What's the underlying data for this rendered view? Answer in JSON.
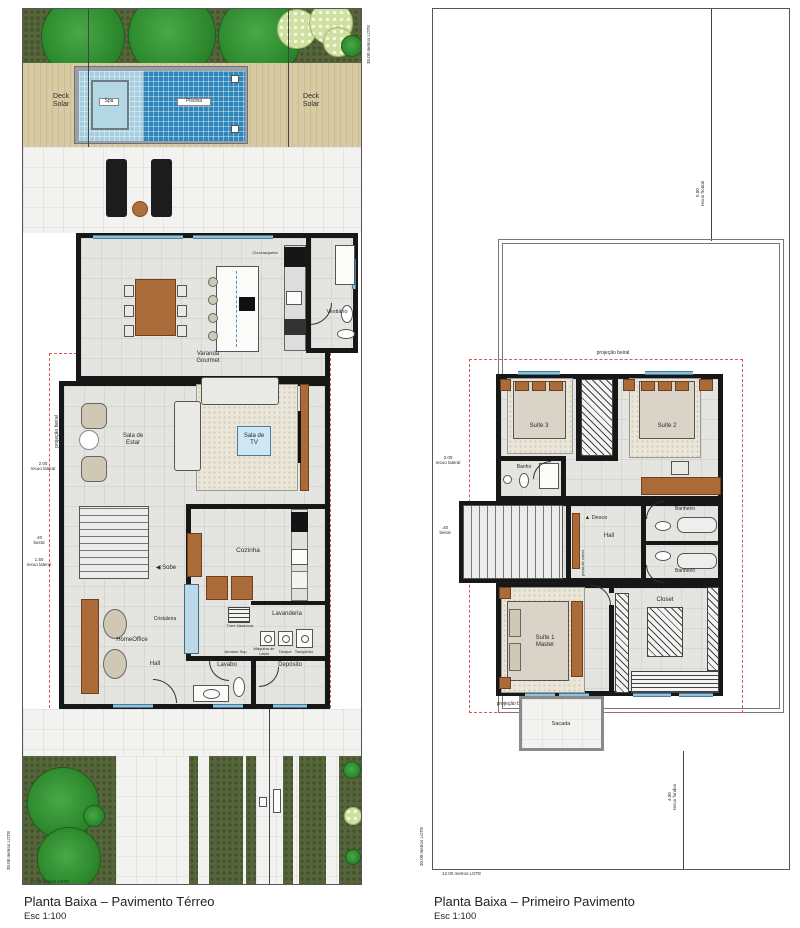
{
  "colors": {
    "wall": "#171717",
    "red_dash": "#dd5555",
    "pool_blue": "#2f86bd",
    "spa_blue": "#a6cede",
    "wood": "#ab6b38",
    "window_blue": "#8fc0dc",
    "garden": "#57653c"
  },
  "left": {
    "title": "Planta Baixa – Pavimento Térreo",
    "scale": "Esc 1:100",
    "lot": {
      "width_label": "12.00 metros LOTE",
      "depth_label": "30.00 metros LOTE"
    },
    "outdoor": {
      "deck_left": "Deck\nSolar",
      "deck_right": "Deck\nSolar",
      "pool": "Piscina",
      "spa": "Spa"
    },
    "rooms": {
      "varanda": "Varanda\nGourmet",
      "churrasqueira": "Churrasqueira",
      "vestiario": "Vestiário",
      "sala_estar": "Sala de\nEstar",
      "sala_tv": "Sala de\nTV",
      "sobe": "Sobe",
      "cozinha": "Cozinha",
      "cristaleira": "Cristaleira",
      "home_office": "HomeOffice",
      "hall": "Hall",
      "lavabo": "Lavabo",
      "deposito": "Depósito",
      "lavanderia": "Lavanderia",
      "maquina": "Máquina de\nLavar",
      "tanque": "Tanque",
      "tanquinho": "Tanquinho",
      "armario": "Armário Sup.",
      "torre": "Torre Vassoura"
    },
    "annotations": {
      "proj_beiral": "projeção beiral",
      "recuo_2": "2.00\nrecuo lateral",
      "beiral_40": ".40\nbeiral",
      "recuo_150": "1.50\nrecuo lateral"
    }
  },
  "right": {
    "title": "Planta Baixa – Primeiro Pavimento",
    "scale": "Esc 1:100",
    "lot": {
      "width_label": "12.00 metros LOTE",
      "depth_label": "30.00 metros LOTE"
    },
    "rooms": {
      "suite3": "Suíte 3",
      "suite2": "Suíte 2",
      "banho": "Banho",
      "hall": "Hall",
      "desce": "Desce",
      "banheiro": "Banheiro",
      "closet": "Closet",
      "suite1": "Suíte 1\nMaster",
      "sacada": "Sacada",
      "porta_correr": "porta de correr"
    },
    "annotations": {
      "proj_beiral": "projeção beiral",
      "recuo_frontal": "5.00\nrecuo frontal",
      "recuo_2": "2.00\nrecuo lateral",
      "beiral_40": ".40\nbeiral",
      "recuo_fundos": "4.00\nrecuo fundos"
    }
  }
}
